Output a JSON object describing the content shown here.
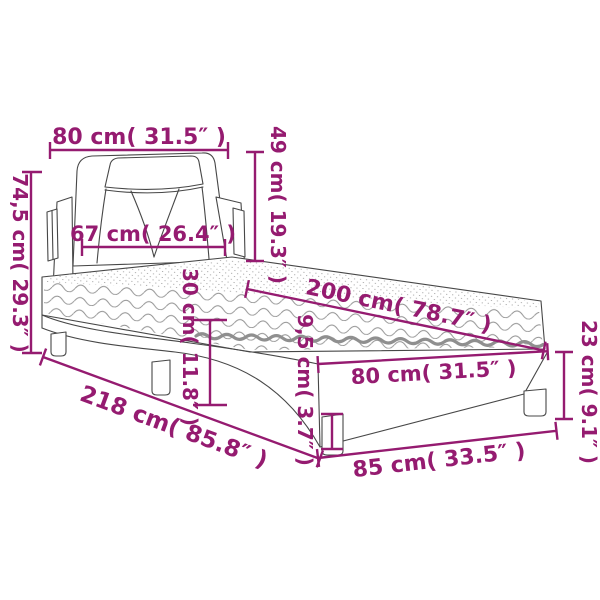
{
  "diagram": {
    "subject": "bed-with-mattress-dimension-diagram",
    "colors": {
      "accent": "#951B70",
      "line_art": "#474747",
      "mattress_stripe": "#8f8f8f",
      "background": "#ffffff"
    },
    "units": [
      "cm",
      "inches"
    ]
  },
  "dimensions": {
    "headboard_width": "80 cm( 31.5″ )",
    "headboard_height": "49 cm( 19.3″ )",
    "overall_height": "74,5 cm( 29.3″ )",
    "headboard_inner_width": "67 cm( 26.4″ )",
    "mattress_length": "200 cm( 78.7″ )",
    "mattress_side_height": "30 cm( 11.8″ )",
    "frame_rail_height": "9,5 cm( 3.7″ )",
    "foot_end_width": "80 cm( 31.5″ )",
    "foot_end_height": "23 cm( 9.1″ )",
    "overall_length": "218 cm( 85.8″ )",
    "foot_end_depth": "85 cm( 33.5″ )"
  }
}
